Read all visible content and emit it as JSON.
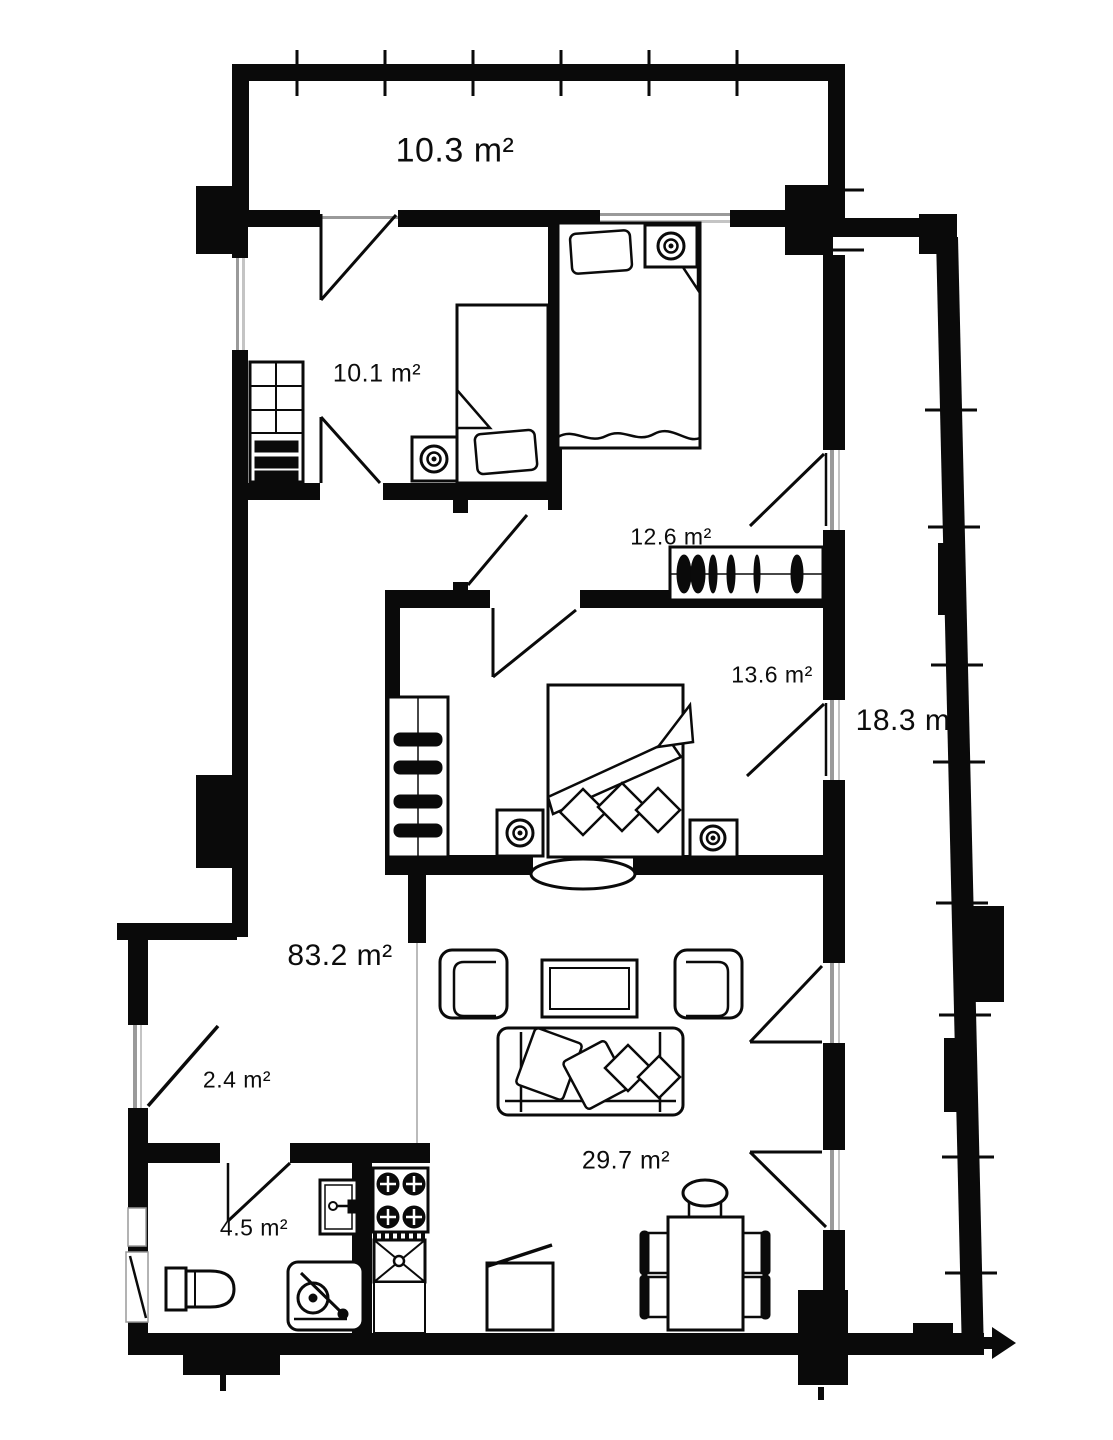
{
  "plan_title": "apartment-floor-plan",
  "rooms": [
    {
      "id": "top-balcony",
      "label": "10.3 m²"
    },
    {
      "id": "bedroom-small",
      "label": "10.1 m²"
    },
    {
      "id": "bedroom-middle",
      "label": "12.6 m²"
    },
    {
      "id": "bedroom-large",
      "label": "13.6 m²"
    },
    {
      "id": "living-room",
      "label": "83.2 m²"
    },
    {
      "id": "entry-hall",
      "label": "2.4 m²"
    },
    {
      "id": "bathroom",
      "label": "4.5 m²"
    },
    {
      "id": "kitchen-dining",
      "label": "29.7 m²"
    },
    {
      "id": "side-balcony",
      "label": "18.3 m"
    }
  ],
  "colors": {
    "wall": "#0a0a0a",
    "window": "#9a9a9a",
    "background": "#ffffff"
  }
}
